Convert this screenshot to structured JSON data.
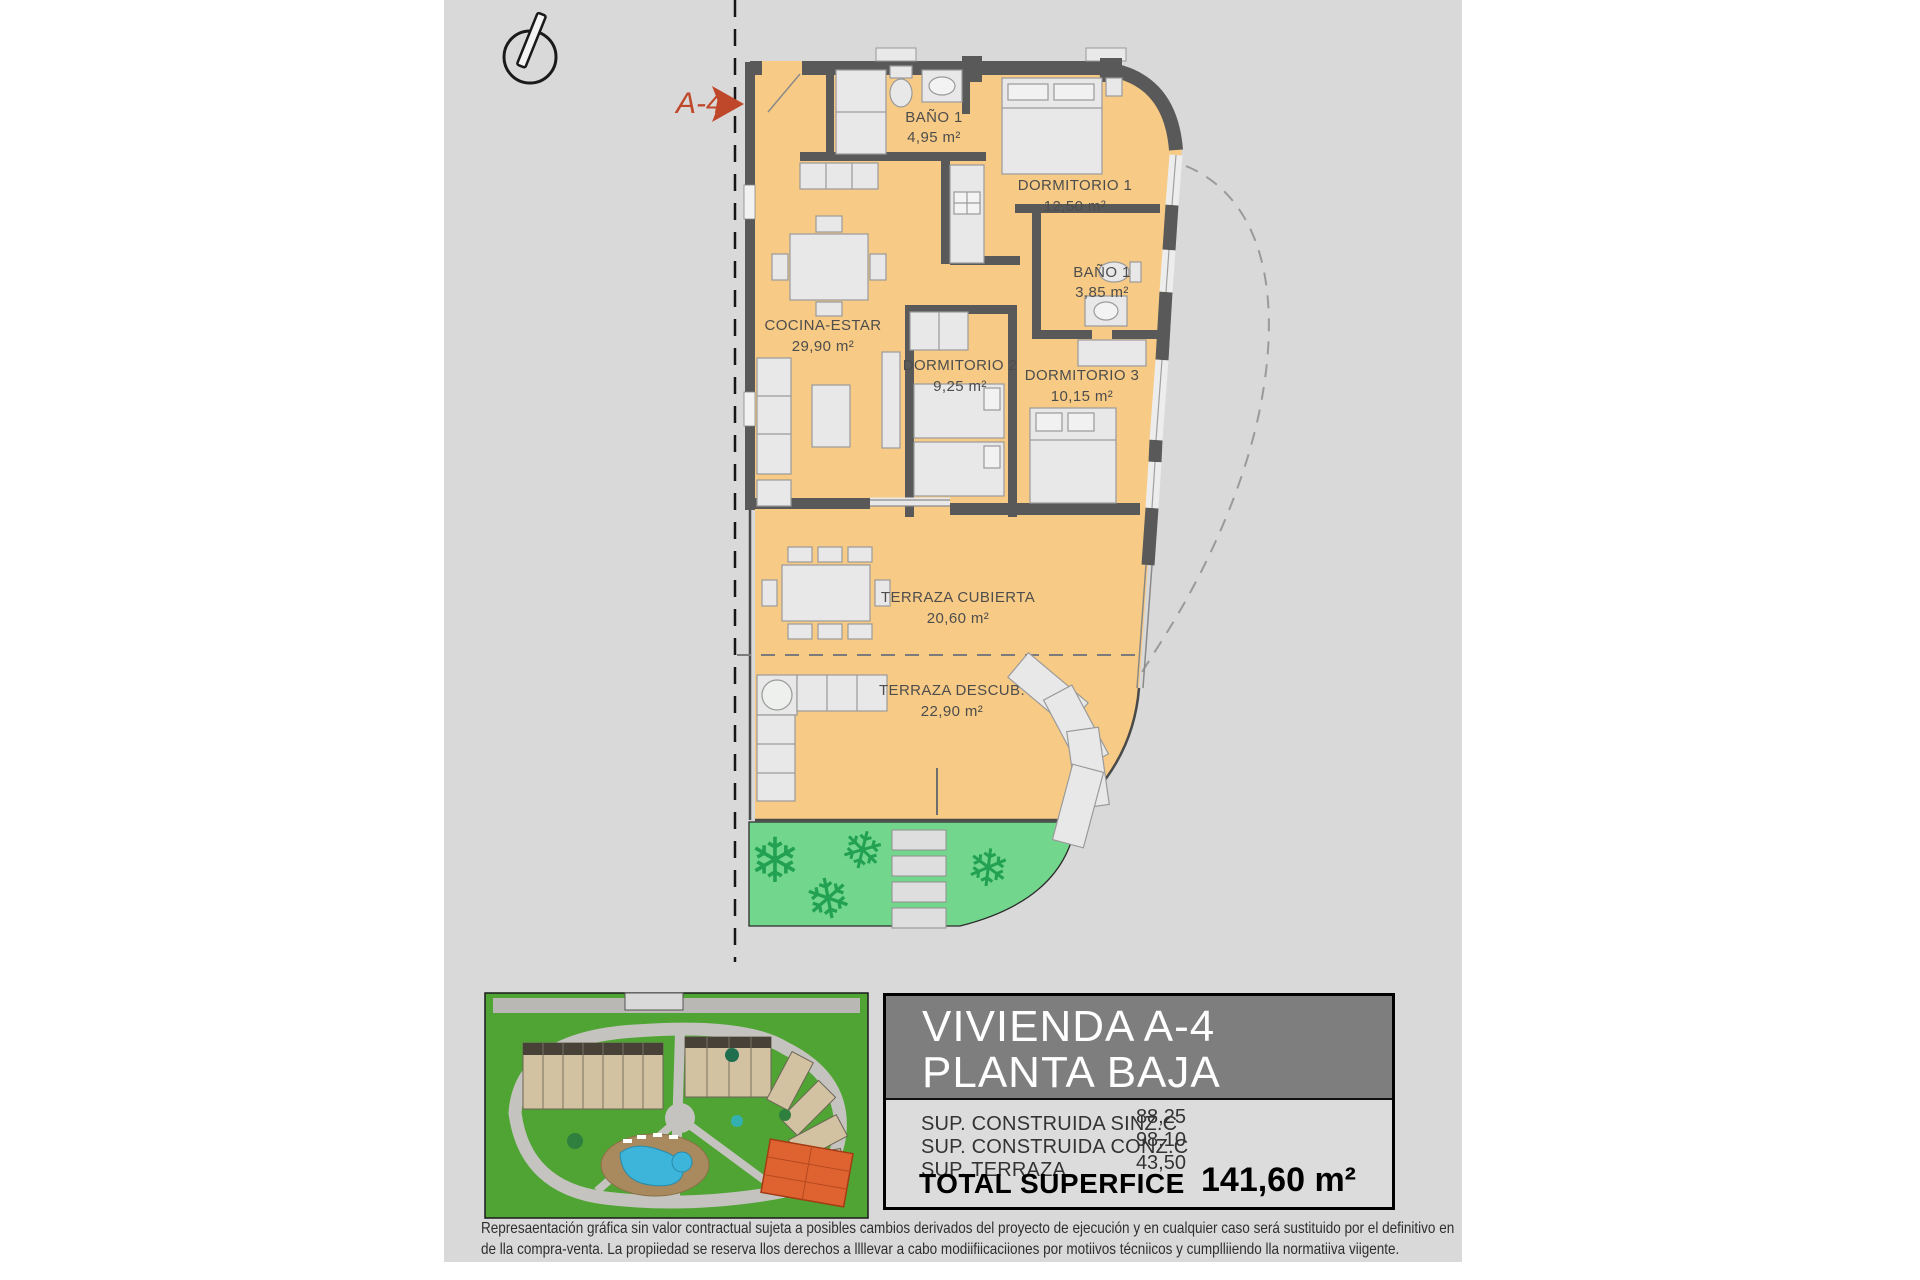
{
  "plan": {
    "unit_marker": "A-4",
    "rooms": [
      {
        "name": "BAÑO 1",
        "area": "4,95 m²"
      },
      {
        "name": "DORMITORIO 1",
        "area": "12,50 m²"
      },
      {
        "name": "BAÑO 1",
        "area": "3,85 m²"
      },
      {
        "name": "COCINA-ESTAR",
        "area": "29,90 m²"
      },
      {
        "name": "DORMITORIO 2",
        "area": "9,25 m²"
      },
      {
        "name": "DORMITORIO 3",
        "area": "10,15 m²"
      },
      {
        "name": "TERRAZA CUBIERTA",
        "area": "20,60 m²"
      },
      {
        "name": "TERRAZA DESCUB.",
        "area": "22,90 m²"
      }
    ],
    "colors": {
      "floor": "#f7cb85",
      "walls": "#595959",
      "garden": "#72d78c",
      "plants": "#22a152",
      "sheet_bg": "#d9d9d9",
      "marker_red": "#c0482a"
    }
  },
  "info_panel": {
    "title_line1": "VIVIENDA A-4",
    "title_line2": "PLANTA BAJA",
    "rows": [
      {
        "label": "SUP. CONSTRUIDA SINZ.C",
        "value": "88,25"
      },
      {
        "label": "SUP. CONSTRUIDA CONZ.C",
        "value": "98,10"
      },
      {
        "label": "SUP. TERRAZA",
        "value": "43,50"
      }
    ],
    "total_label": "TOTAL SUPERFICE",
    "total_value": "141,60 m²",
    "header_bg": "#7e7e7e"
  },
  "disclaimer": {
    "line1": "Represaentación gráfica sin valor contractual sujeta a posibles cambios derivados del proyecto de ejecución y en cualquier caso será sustituido por el definitivo en",
    "line2": "de lla compra-venta. La propiiedad se reserva llos derechos a llllevar a cabo modiifiicaciiones por motiivos técniicos y cumplliiendo lla normatiiva viigente."
  }
}
